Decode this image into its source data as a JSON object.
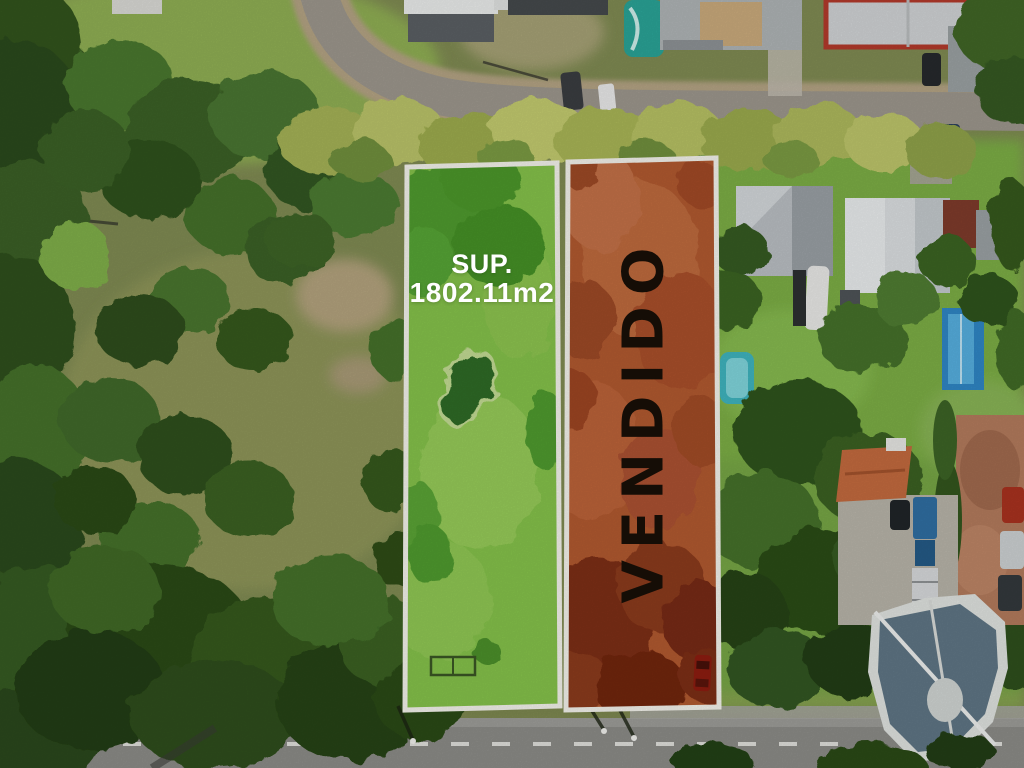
{
  "lots": {
    "available": {
      "surface_label": "SUP.",
      "surface_area": "1802.11m2",
      "overlay_color": "#84c14a",
      "border_color": "#f2f1ea",
      "label_color": "#ffffff"
    },
    "sold": {
      "status": "VENDIDO",
      "overlay_color": "#b0592f",
      "border_color": "#f2f1ea",
      "label_color": "#150d06"
    }
  }
}
